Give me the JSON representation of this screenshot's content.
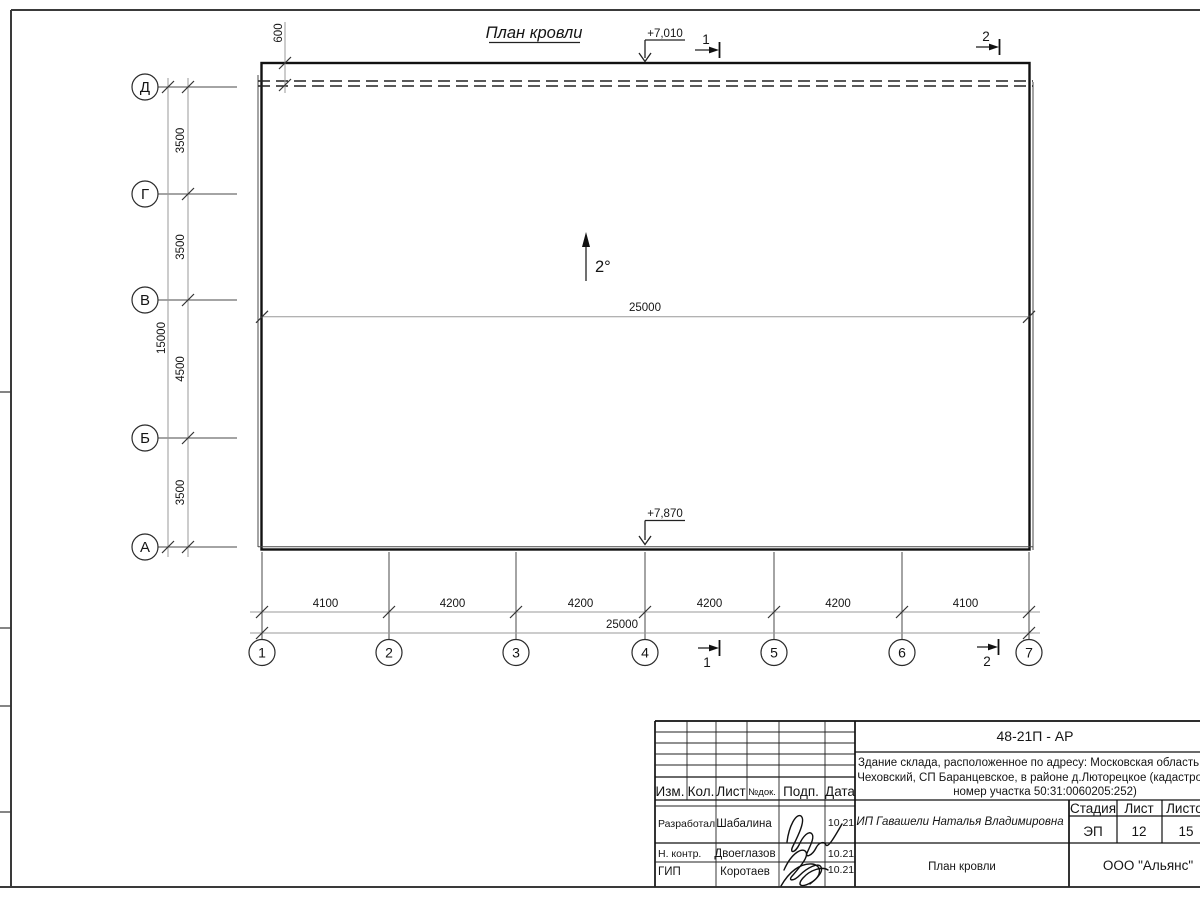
{
  "plan": {
    "title": "План кровли",
    "slope": "2°",
    "elev_top": "+7,010",
    "elev_bottom": "+7,870",
    "overhang_dim": "600",
    "inner_total_dim": "25000",
    "row_axes": [
      "Д",
      "Г",
      "В",
      "Б",
      "А"
    ],
    "row_dims": [
      "3500",
      "3500",
      "4500",
      "3500"
    ],
    "row_total": "15000",
    "col_axes": [
      "1",
      "2",
      "3",
      "4",
      "5",
      "6",
      "7"
    ],
    "col_dims": [
      "4100",
      "4200",
      "4200",
      "4200",
      "4200",
      "4100"
    ],
    "col_total": "25000",
    "section_marks": {
      "s1": "1",
      "s2": "2"
    }
  },
  "titleblock": {
    "doc_number": "48-21П - АР",
    "project_lines": [
      "Здание склада, расположенное по адресу: Московская область, р-н",
      "Чеховский, СП Баранцевское, в районе д.Люторецкое  (кадастровый",
      "номер участка 50:31:0060205:252)"
    ],
    "header": {
      "izm": "Изм.",
      "kol": "Кол.",
      "list": "Лист",
      "ndok": "№док.",
      "podp": "Подп.",
      "data": "Дата"
    },
    "rows": [
      {
        "role": "Разработал",
        "name": "Шабалина",
        "date": "10.21"
      },
      {
        "role": "Н. контр.",
        "name": "Двоеглазов",
        "date": "10.21"
      },
      {
        "role": "ГИП",
        "name": "Коротаев",
        "date": "10.21"
      }
    ],
    "client": "ИП Гавашели Наталья Владимировна",
    "stage_label": "Стадия",
    "sheet_label": "Лист",
    "sheets_label": "Листов",
    "stage": "ЭП",
    "sheet": "12",
    "sheets": "15",
    "sheet_title": "План кровли",
    "company": "ООО \"Альянс\""
  }
}
